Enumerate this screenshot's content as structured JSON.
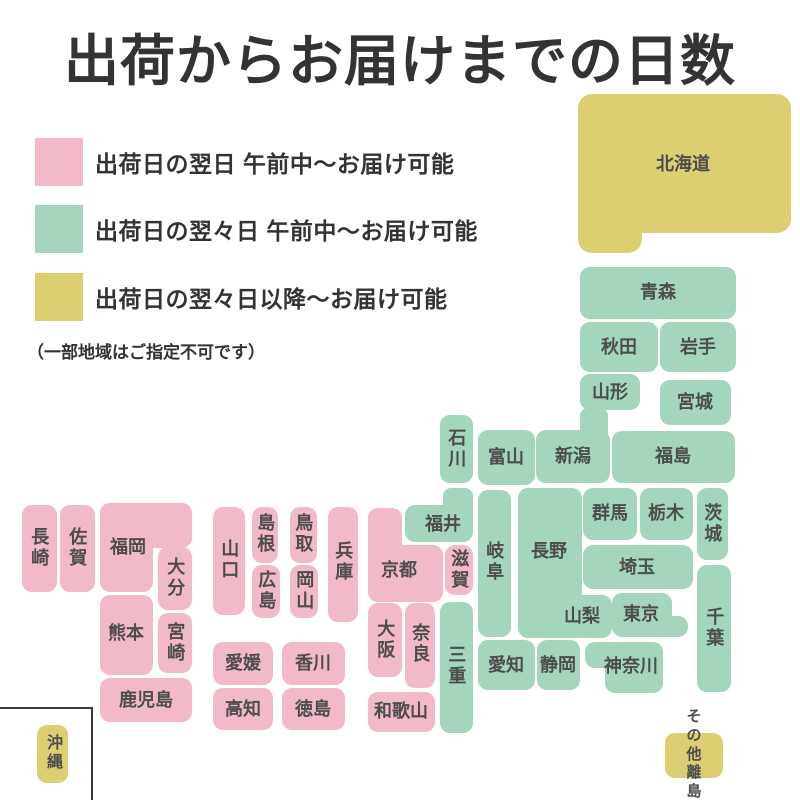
{
  "title": "出荷からお届けまでの日数",
  "colors": {
    "pink": "#f2bac8",
    "green": "#a3d6bd",
    "yellow": "#dccf72",
    "heading_text": "#333333",
    "label_text": "#4d4d4d",
    "inset_border": "#3a3a3a"
  },
  "legend": {
    "items": [
      {
        "color_key": "pink",
        "color": "#f2bac8",
        "label": "出荷日の翌日 午前中〜お届け可能"
      },
      {
        "color_key": "green",
        "color": "#a3d6bd",
        "label": "出荷日の翌々日 午前中〜お届け可能"
      },
      {
        "color_key": "yellow",
        "color": "#dccf72",
        "label": "出荷日の翌々日以降〜お届け可能"
      }
    ],
    "note": "（一部地域はご指定不可です）"
  },
  "map": {
    "blocks": [
      {
        "id": "hokkaido",
        "name": "北海道",
        "color": "yellow",
        "rects": [
          {
            "x": 578,
            "y": 94,
            "w": 213,
            "h": 139,
            "r": "14px"
          },
          {
            "x": 578,
            "y": 180,
            "w": 64,
            "h": 73,
            "r": "0 0 14px 14px"
          }
        ],
        "label": {
          "x": 683,
          "y": 164,
          "v": false
        }
      },
      {
        "id": "aomori",
        "name": "青森",
        "color": "green",
        "rects": [
          {
            "x": 580,
            "y": 267,
            "w": 156,
            "h": 52
          }
        ],
        "label": {
          "x": 658,
          "y": 292,
          "v": false
        }
      },
      {
        "id": "akita",
        "name": "秋田",
        "color": "green",
        "rects": [
          {
            "x": 580,
            "y": 322,
            "w": 78,
            "h": 50
          }
        ],
        "label": {
          "x": 619,
          "y": 347,
          "v": false
        }
      },
      {
        "id": "iwate",
        "name": "岩手",
        "color": "green",
        "rects": [
          {
            "x": 660,
            "y": 322,
            "w": 76,
            "h": 50
          }
        ],
        "label": {
          "x": 698,
          "y": 347,
          "v": false
        }
      },
      {
        "id": "yamagata",
        "name": "山形",
        "color": "green",
        "rects": [
          {
            "x": 580,
            "y": 374,
            "w": 60,
            "h": 36
          }
        ],
        "label": {
          "x": 610,
          "y": 392,
          "v": false
        }
      },
      {
        "id": "miyagi",
        "name": "宮城",
        "color": "green",
        "rects": [
          {
            "x": 660,
            "y": 380,
            "w": 71,
            "h": 45
          }
        ],
        "label": {
          "x": 695,
          "y": 402,
          "v": false
        }
      },
      {
        "id": "fukushima",
        "name": "福島",
        "color": "green",
        "rects": [
          {
            "x": 612,
            "y": 431,
            "w": 123,
            "h": 52
          }
        ],
        "label": {
          "x": 673,
          "y": 456,
          "v": false
        }
      },
      {
        "id": "niigata",
        "name": "新潟",
        "color": "green",
        "rects": [
          {
            "x": 536,
            "y": 430,
            "w": 74,
            "h": 53,
            "r": "10px"
          },
          {
            "x": 580,
            "y": 408,
            "w": 28,
            "h": 32,
            "r": "8px 8px 0 0"
          }
        ],
        "label": {
          "x": 573,
          "y": 456,
          "v": false
        }
      },
      {
        "id": "toyama",
        "name": "富山",
        "color": "green",
        "rects": [
          {
            "x": 478,
            "y": 430,
            "w": 57,
            "h": 55
          }
        ],
        "label": {
          "x": 506,
          "y": 457,
          "v": false
        }
      },
      {
        "id": "ishikawa",
        "name": "石川",
        "color": "green",
        "rects": [
          {
            "x": 440,
            "y": 415,
            "w": 33,
            "h": 68
          }
        ],
        "label": {
          "x": 456,
          "y": 449,
          "v": true
        }
      },
      {
        "id": "fukui",
        "name": "福井",
        "color": "green",
        "rects": [
          {
            "x": 443,
            "y": 488,
            "w": 30,
            "h": 30,
            "r": "8px 8px 0 0"
          },
          {
            "x": 405,
            "y": 505,
            "w": 68,
            "h": 37,
            "r": "10px"
          }
        ],
        "label": {
          "x": 443,
          "y": 524,
          "v": false
        }
      },
      {
        "id": "gifu",
        "name": "岐阜",
        "color": "green",
        "rects": [
          {
            "x": 478,
            "y": 490,
            "w": 33,
            "h": 147
          }
        ],
        "label": {
          "x": 494,
          "y": 562,
          "v": true
        }
      },
      {
        "id": "nagano",
        "name": "長野",
        "color": "green",
        "rects": [
          {
            "x": 518,
            "y": 488,
            "w": 64,
            "h": 150
          }
        ],
        "label": {
          "x": 549,
          "y": 551,
          "v": false
        }
      },
      {
        "id": "gunma",
        "name": "群馬",
        "color": "green",
        "rects": [
          {
            "x": 583,
            "y": 488,
            "w": 54,
            "h": 52
          }
        ],
        "label": {
          "x": 610,
          "y": 513,
          "v": false
        }
      },
      {
        "id": "tochigi",
        "name": "栃木",
        "color": "green",
        "rects": [
          {
            "x": 640,
            "y": 488,
            "w": 53,
            "h": 52
          }
        ],
        "label": {
          "x": 666,
          "y": 513,
          "v": false
        }
      },
      {
        "id": "ibaraki",
        "name": "茨城",
        "color": "green",
        "rects": [
          {
            "x": 697,
            "y": 488,
            "w": 31,
            "h": 72
          }
        ],
        "label": {
          "x": 712,
          "y": 524,
          "v": true
        }
      },
      {
        "id": "saitama",
        "name": "埼玉",
        "color": "green",
        "rects": [
          {
            "x": 583,
            "y": 545,
            "w": 110,
            "h": 44
          }
        ],
        "label": {
          "x": 637,
          "y": 567,
          "v": false
        }
      },
      {
        "id": "yamanashi",
        "name": "山梨",
        "color": "green",
        "rects": [
          {
            "x": 552,
            "y": 595,
            "w": 60,
            "h": 43
          }
        ],
        "label": {
          "x": 582,
          "y": 616,
          "v": false
        }
      },
      {
        "id": "tokyo",
        "name": "東京",
        "color": "green",
        "rects": [
          {
            "x": 612,
            "y": 593,
            "w": 60,
            "h": 44,
            "r": "10px"
          },
          {
            "x": 652,
            "y": 616,
            "w": 36,
            "h": 21,
            "r": "0 10px 10px 0"
          }
        ],
        "label": {
          "x": 641,
          "y": 614,
          "v": false
        }
      },
      {
        "id": "chiba",
        "name": "千葉",
        "color": "green",
        "rects": [
          {
            "x": 697,
            "y": 565,
            "w": 34,
            "h": 127
          }
        ],
        "label": {
          "x": 714,
          "y": 628,
          "v": true
        }
      },
      {
        "id": "kanagawa",
        "name": "神奈川",
        "color": "green",
        "rects": [
          {
            "x": 585,
            "y": 642,
            "w": 78,
            "h": 26,
            "r": "10px 10px 0 10px"
          },
          {
            "x": 605,
            "y": 650,
            "w": 58,
            "h": 43,
            "r": "0 0 10px 10px"
          }
        ],
        "label": {
          "x": 631,
          "y": 666,
          "v": false
        }
      },
      {
        "id": "shizuoka",
        "name": "静岡",
        "color": "green",
        "rects": [
          {
            "x": 537,
            "y": 640,
            "w": 43,
            "h": 50
          }
        ],
        "label": {
          "x": 558,
          "y": 665,
          "v": false
        }
      },
      {
        "id": "aichi",
        "name": "愛知",
        "color": "green",
        "rects": [
          {
            "x": 478,
            "y": 640,
            "w": 57,
            "h": 50
          }
        ],
        "label": {
          "x": 506,
          "y": 665,
          "v": false
        }
      },
      {
        "id": "mie",
        "name": "三重",
        "color": "green",
        "rects": [
          {
            "x": 440,
            "y": 602,
            "w": 33,
            "h": 131
          }
        ],
        "label": {
          "x": 456,
          "y": 666,
          "v": true
        }
      },
      {
        "id": "shiga",
        "name": "滋賀",
        "color": "pink",
        "rects": [
          {
            "x": 445,
            "y": 545,
            "w": 28,
            "h": 50
          }
        ],
        "label": {
          "x": 459,
          "y": 570,
          "v": true
        }
      },
      {
        "id": "kyoto",
        "name": "京都",
        "color": "pink",
        "rects": [
          {
            "x": 368,
            "y": 508,
            "w": 34,
            "h": 45,
            "r": "10px 10px 0 0"
          },
          {
            "x": 368,
            "y": 545,
            "w": 75,
            "h": 57,
            "r": "0 10px 10px 10px"
          }
        ],
        "label": {
          "x": 399,
          "y": 570,
          "v": false
        }
      },
      {
        "id": "hyogo",
        "name": "兵庫",
        "color": "pink",
        "rects": [
          {
            "x": 328,
            "y": 507,
            "w": 30,
            "h": 115
          }
        ],
        "label": {
          "x": 343,
          "y": 562,
          "v": true
        }
      },
      {
        "id": "osaka",
        "name": "大阪",
        "color": "pink",
        "rects": [
          {
            "x": 368,
            "y": 603,
            "w": 34,
            "h": 74
          }
        ],
        "label": {
          "x": 385,
          "y": 640,
          "v": true
        }
      },
      {
        "id": "nara",
        "name": "奈良",
        "color": "pink",
        "rects": [
          {
            "x": 405,
            "y": 603,
            "w": 30,
            "h": 85
          }
        ],
        "label": {
          "x": 420,
          "y": 644,
          "v": true
        }
      },
      {
        "id": "wakayama",
        "name": "和歌山",
        "color": "pink",
        "rects": [
          {
            "x": 368,
            "y": 692,
            "w": 67,
            "h": 40
          }
        ],
        "label": {
          "x": 401,
          "y": 711,
          "v": false
        }
      },
      {
        "id": "tottori",
        "name": "鳥取",
        "color": "pink",
        "rects": [
          {
            "x": 290,
            "y": 507,
            "w": 27,
            "h": 56
          }
        ],
        "label": {
          "x": 303,
          "y": 534,
          "v": true
        }
      },
      {
        "id": "shimane",
        "name": "島根",
        "color": "pink",
        "rects": [
          {
            "x": 252,
            "y": 507,
            "w": 26,
            "h": 56
          }
        ],
        "label": {
          "x": 265,
          "y": 534,
          "v": true
        }
      },
      {
        "id": "okayama",
        "name": "岡山",
        "color": "pink",
        "rects": [
          {
            "x": 290,
            "y": 565,
            "w": 28,
            "h": 53
          }
        ],
        "label": {
          "x": 304,
          "y": 591,
          "v": true
        }
      },
      {
        "id": "hiroshima",
        "name": "広島",
        "color": "pink",
        "rects": [
          {
            "x": 252,
            "y": 565,
            "w": 28,
            "h": 53
          }
        ],
        "label": {
          "x": 266,
          "y": 591,
          "v": true
        }
      },
      {
        "id": "yamaguchi",
        "name": "山口",
        "color": "pink",
        "rects": [
          {
            "x": 213,
            "y": 507,
            "w": 32,
            "h": 108
          }
        ],
        "label": {
          "x": 229,
          "y": 560,
          "v": true
        }
      },
      {
        "id": "ehime",
        "name": "愛媛",
        "color": "pink",
        "rects": [
          {
            "x": 213,
            "y": 642,
            "w": 60,
            "h": 43
          }
        ],
        "label": {
          "x": 243,
          "y": 663,
          "v": false
        }
      },
      {
        "id": "kagawa",
        "name": "香川",
        "color": "pink",
        "rects": [
          {
            "x": 282,
            "y": 642,
            "w": 63,
            "h": 43
          }
        ],
        "label": {
          "x": 313,
          "y": 663,
          "v": false
        }
      },
      {
        "id": "kochi",
        "name": "高知",
        "color": "pink",
        "rects": [
          {
            "x": 213,
            "y": 688,
            "w": 60,
            "h": 42
          }
        ],
        "label": {
          "x": 243,
          "y": 709,
          "v": false
        }
      },
      {
        "id": "tokushima",
        "name": "徳島",
        "color": "pink",
        "rects": [
          {
            "x": 282,
            "y": 688,
            "w": 63,
            "h": 42
          }
        ],
        "label": {
          "x": 313,
          "y": 709,
          "v": false
        }
      },
      {
        "id": "fukuoka",
        "name": "福岡",
        "color": "pink",
        "rects": [
          {
            "x": 100,
            "y": 503,
            "w": 92,
            "h": 45,
            "r": "10px 10px 10px 0"
          },
          {
            "x": 100,
            "y": 503,
            "w": 53,
            "h": 89,
            "r": "10px 0 10px 10px"
          }
        ],
        "label": {
          "x": 128,
          "y": 547,
          "v": false
        }
      },
      {
        "id": "oita",
        "name": "大分",
        "color": "pink",
        "rects": [
          {
            "x": 158,
            "y": 547,
            "w": 34,
            "h": 63
          }
        ],
        "label": {
          "x": 175,
          "y": 578,
          "v": true
        }
      },
      {
        "id": "kumamoto",
        "name": "熊本",
        "color": "pink",
        "rects": [
          {
            "x": 100,
            "y": 595,
            "w": 53,
            "h": 80
          }
        ],
        "label": {
          "x": 126,
          "y": 633,
          "v": false
        }
      },
      {
        "id": "miyazaki",
        "name": "宮崎",
        "color": "pink",
        "rects": [
          {
            "x": 158,
            "y": 613,
            "w": 34,
            "h": 60
          }
        ],
        "label": {
          "x": 175,
          "y": 643,
          "v": true
        }
      },
      {
        "id": "kagoshima",
        "name": "鹿児島",
        "color": "pink",
        "rects": [
          {
            "x": 100,
            "y": 678,
            "w": 92,
            "h": 44
          }
        ],
        "label": {
          "x": 146,
          "y": 700,
          "v": false
        }
      },
      {
        "id": "nagasaki",
        "name": "長崎",
        "color": "pink",
        "rects": [
          {
            "x": 22,
            "y": 505,
            "w": 35,
            "h": 87
          }
        ],
        "label": {
          "x": 39,
          "y": 548,
          "v": true
        }
      },
      {
        "id": "saga",
        "name": "佐賀",
        "color": "pink",
        "rects": [
          {
            "x": 60,
            "y": 505,
            "w": 35,
            "h": 87
          }
        ],
        "label": {
          "x": 77,
          "y": 548,
          "v": true
        }
      },
      {
        "id": "okinawa",
        "name": "沖縄",
        "color": "yellow",
        "rects": [
          {
            "x": 37,
            "y": 725,
            "w": 31,
            "h": 58
          }
        ],
        "label": {
          "x": 52,
          "y": 753,
          "v": true,
          "size": 16
        }
      },
      {
        "id": "other-islands",
        "name": "その他離島",
        "color": "yellow",
        "rects": [
          {
            "x": 665,
            "y": 733,
            "w": 58,
            "h": 45
          }
        ],
        "label": {
          "x": 694,
          "y": 755,
          "v": false,
          "size": 15,
          "lines": [
            "その他",
            "離島"
          ]
        }
      }
    ],
    "inset": {
      "x": -10,
      "y": 707,
      "w": 99,
      "h": 120
    }
  }
}
